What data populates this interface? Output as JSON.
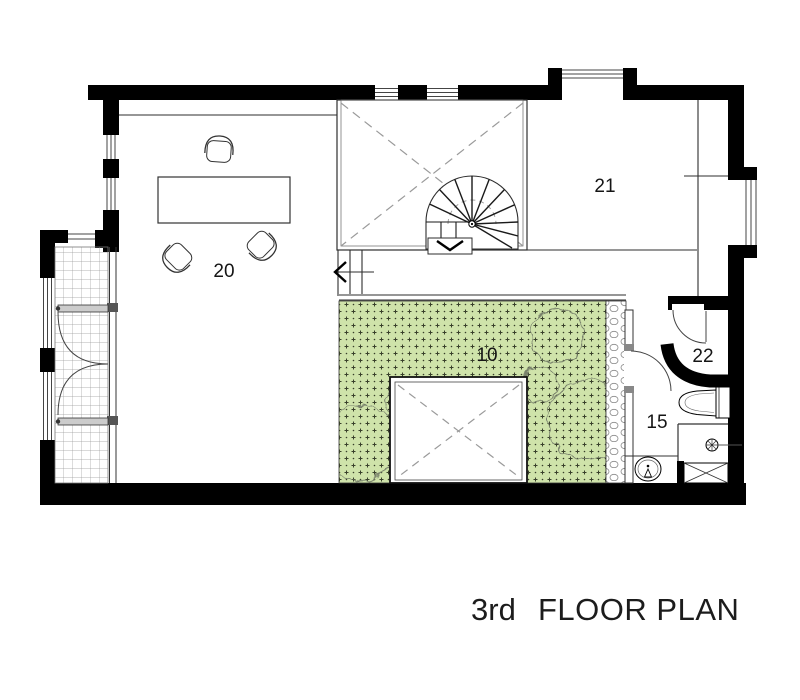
{
  "title": {
    "prefix": "3rd",
    "main": "FLOOR PLAN"
  },
  "rooms": {
    "office": {
      "label": "20"
    },
    "room21": {
      "label": "21"
    },
    "terrace": {
      "label": "10"
    },
    "room22": {
      "label": "22"
    },
    "bathroom": {
      "label": "15"
    }
  },
  "colors": {
    "wall": "#000000",
    "terrace_green": "#cfe3aa",
    "terrace_mark": "#39402b",
    "line": "#2e2e2e"
  }
}
